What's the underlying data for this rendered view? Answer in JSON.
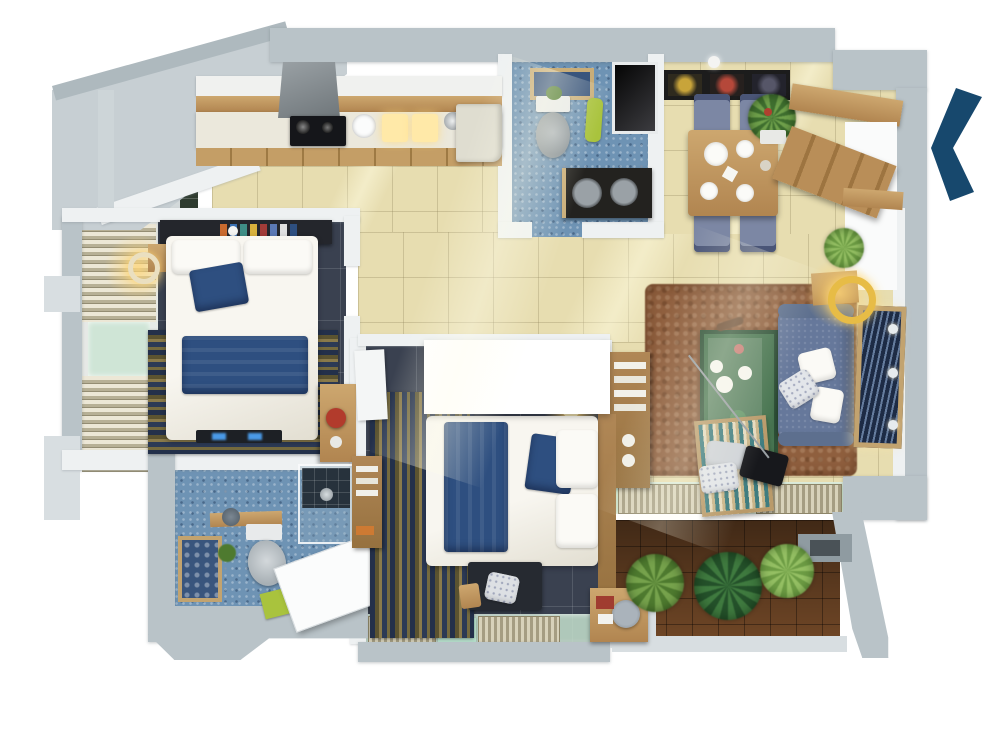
{
  "scene": {
    "type": "3d-apartment-floor-plan-top-view",
    "background": "#ffffff",
    "no_visible_text": true
  },
  "nav": {
    "chevron_icon": "chevron-left-icon",
    "chevron_color": "#17486d",
    "chevron_direction": "left"
  },
  "palette": {
    "outer_wall": "#b9c3c8",
    "outer_wall_light": "#d8dee1",
    "inner_wall": "#eef1f2",
    "tile_floor": "#e7ddb0",
    "bedroom_floor": "#3a4150",
    "bathroom_mosaic": "#6e93b4",
    "balcony_tile": "#754a28",
    "rug_brown": "#8f5f3e",
    "sofa_blue": "#66789b",
    "textile_blue": "#2e4f80",
    "duvet_white": "#f4f2ea",
    "wood": "#c49d64",
    "coffee_table_green": "#477450",
    "glass_mint": "#cfe5d6",
    "lamp_glow": "#ffd98a",
    "stove_black": "#15161a",
    "headboard_black": "#24262c",
    "towel_green": "#a9c33d",
    "chair_red": "#b23b2c"
  },
  "rooms": [
    {
      "id": "kitchen",
      "floor": "#e7ddb0"
    },
    {
      "id": "bathroom-top",
      "floor": "#6e93b4"
    },
    {
      "id": "dining-area",
      "floor": "#e7ddb0"
    },
    {
      "id": "entry",
      "floor": "#e7ddb0"
    },
    {
      "id": "living-room",
      "floor": "#e7ddb0"
    },
    {
      "id": "corridor",
      "floor": "#e7ddb0"
    },
    {
      "id": "bedroom-left",
      "floor": "#3a4150"
    },
    {
      "id": "bedroom-center",
      "floor": "#3a4150"
    },
    {
      "id": "bathroom-bottom",
      "floor": "#6e93b4"
    },
    {
      "id": "balcony-terrace",
      "floor": "#754a28"
    },
    {
      "id": "utility-balcony",
      "floor": "#d3d9da"
    }
  ],
  "furniture": {
    "kitchen": [
      "upper-cabinets",
      "counter",
      "range-hood",
      "cooktop",
      "sink",
      "cutting-boards",
      "fridge"
    ],
    "bathroom_top": [
      "wall-picture",
      "toilet",
      "plant",
      "towel",
      "vanity-double-sink",
      "duct-shaft"
    ],
    "dining": [
      "wall-art-frames",
      "ceiling-lamp",
      "dining-table",
      "chairs",
      "plates",
      "potted-plant",
      "sideboard",
      "entry-door"
    ],
    "living": [
      "brown-rug",
      "bookshelf",
      "coffee-table",
      "sofa",
      "throw-pillows",
      "wall-art-panel",
      "ring-floor-lamp",
      "corner-plant",
      "lounge-chair",
      "speaker",
      "glass-floor-walkway"
    ],
    "bedroom_left": [
      "headboard-shelf",
      "double-bed",
      "blue-pillow",
      "blue-blanket",
      "striped-rug",
      "nightstand",
      "bedside-lamp",
      "media-console",
      "desk",
      "red-chair",
      "window-blinds"
    ],
    "bedroom_center": [
      "wardrobe-overhang",
      "striped-rug",
      "double-bed",
      "blue-blanket",
      "blue-pillow",
      "headboard",
      "bench",
      "nightstand",
      "table-lamp",
      "wall-shelf",
      "glass-floor-walkway"
    ],
    "bathroom_bottom": [
      "shower-cabin",
      "wood-counter-sink",
      "toilet",
      "wall-picture",
      "plant",
      "bath-mat",
      "open-door"
    ],
    "balcony": [
      "palm-plant",
      "dark-bush",
      "light-bush",
      "wall-recess"
    ],
    "utility_balcony": [
      "washer",
      "palm-plant",
      "window-glass"
    ]
  }
}
